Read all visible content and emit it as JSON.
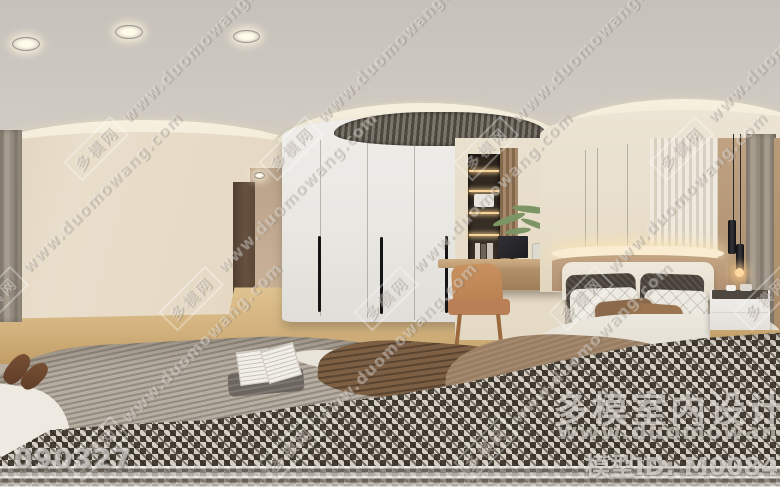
{
  "watermark": {
    "logo_text": "多模网",
    "url": "www.duomowang.com"
  },
  "stamps": {
    "photo_id": "090327"
  },
  "footer": {
    "site_name": "多模室内设计网",
    "site_url": "www.duomowang.com",
    "model_id_label": "模型ID: M0084305"
  },
  "palette": {
    "ceiling": "#cdc8c1",
    "crown_cove": "#f4eedd",
    "left_wall": "#e7ddca",
    "wardrobe": "#ebe9e4",
    "wardrobe_handle": "#141414",
    "air_vent": "#55504a",
    "door": "#5f4c3c",
    "wood_floor": "#d7b88a",
    "shelf_niche": "#352c23",
    "shelf_glow": "#f5cf93",
    "desk_wood": "#bb9a72",
    "chair": "#c08a60",
    "monitor": "#26262a",
    "plant": "#7d9465",
    "accent_band": "#b79878",
    "led_glow": "#f9ecd0",
    "headboard": "#ebe5d8",
    "pillow_dark": "#474139",
    "pillow_white": "#edeae2",
    "pillow_brown": "#8b6a4b",
    "duvet": "#e9e5dc",
    "nightstand": "#f0eeea",
    "pendant": "#1d1d1f",
    "curtain": "#9a9084",
    "rug_stripe": "#a49a8e",
    "blanket_brown": "#7d5f44",
    "throw_brown": "#9a7e61",
    "houndstooth_dark": "#463f36",
    "houndstooth_light": "#d6cfc3"
  }
}
